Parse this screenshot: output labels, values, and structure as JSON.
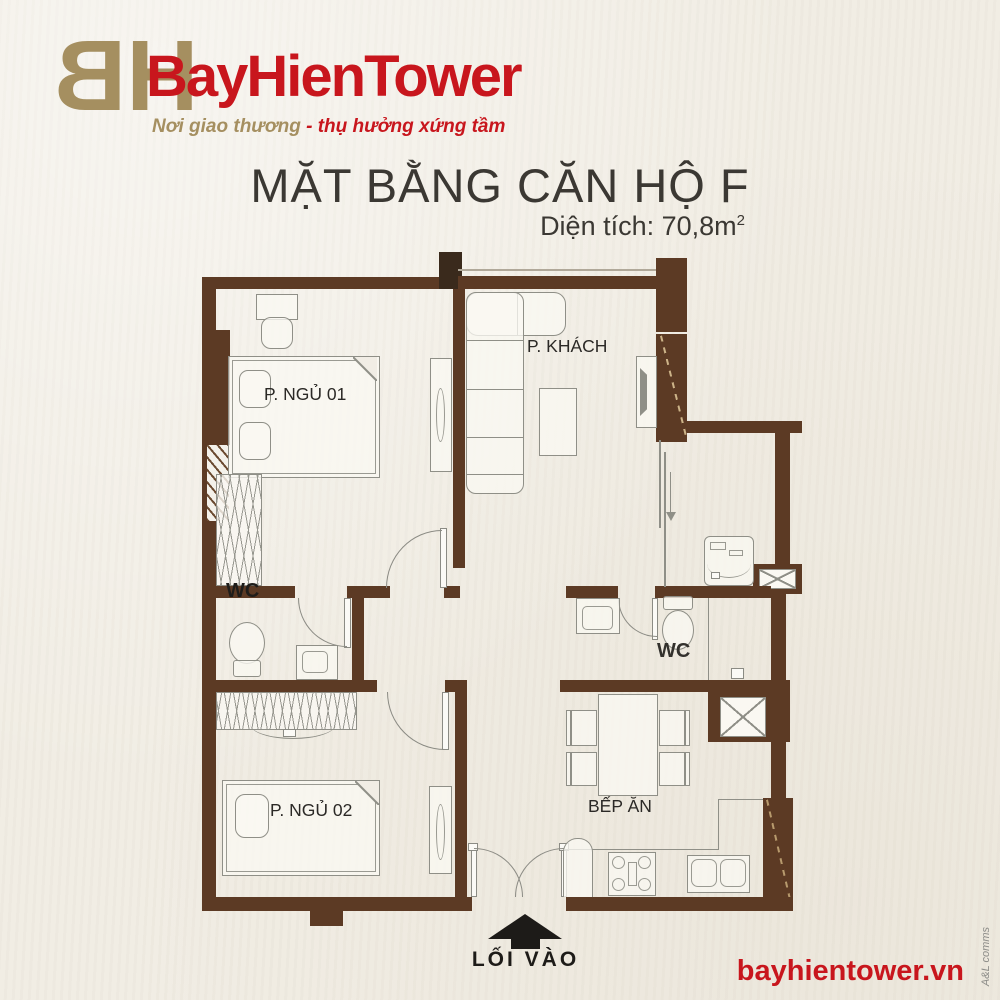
{
  "brand": {
    "monogram_b": "B",
    "monogram_h": "H",
    "name": "BayHienTower",
    "tagline_gold": "Nơi giao thương",
    "tagline_red": "- thụ hưởng xứng tầm"
  },
  "title": {
    "main": "MẶT BẰNG CĂN HỘ F",
    "area_label": "Diện tích: 70,8m",
    "area_sup": "2"
  },
  "rooms": {
    "bedroom1": "P. NGỦ 01",
    "living": "P. KHÁCH",
    "wc1": "WC",
    "wc2": "WC",
    "bedroom2": "P. NGỦ 02",
    "kitchen": "BẾP ĂN"
  },
  "entrance": {
    "label": "LỐI VÀO",
    "arrow_icon": "up-arrow"
  },
  "footer": {
    "website": "bayhientower.vn",
    "credit": "A&L comms"
  },
  "colors": {
    "wall": "#5c3a24",
    "column_dark": "#3a2a1c",
    "brand_red": "#c8161d",
    "brand_gold": "#a58f60",
    "line_gray": "#8f8f87",
    "background": "#f1ede4",
    "text_dark": "#3b3833"
  }
}
